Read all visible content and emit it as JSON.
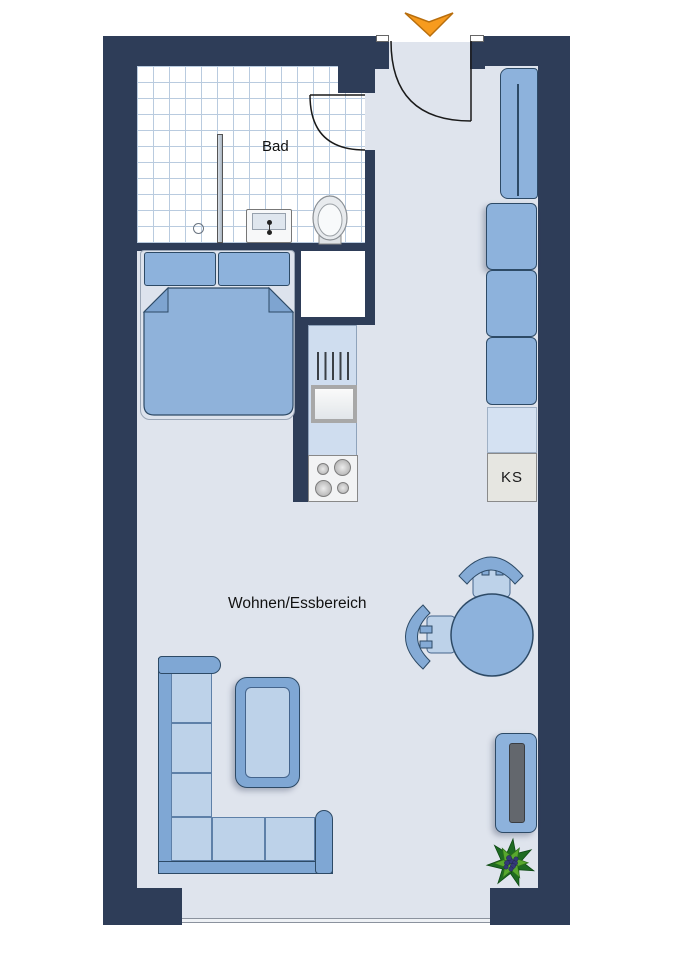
{
  "page": {
    "type": "apartment-floor-plan",
    "background": "#ffffff"
  },
  "labels": {
    "bathroom": "Bad",
    "living_dining": "Wohnen/Essbereich",
    "fridge": "KS"
  },
  "colors": {
    "wall": "#2e3d58",
    "floor": "#dfe4ed",
    "bathroom_tile_line": "#b9cbdf",
    "furniture_blue": "#8db2dc",
    "furniture_light_blue": "#bdd2e9",
    "furniture_outline": "#2d4a66",
    "counter_blue": "#cfddef",
    "fridge_gray": "#e6e6e1",
    "entrance_arrow_orange": "#f79b1e",
    "plant_green": "#58a82e",
    "plant_berries": "#343a78"
  }
}
